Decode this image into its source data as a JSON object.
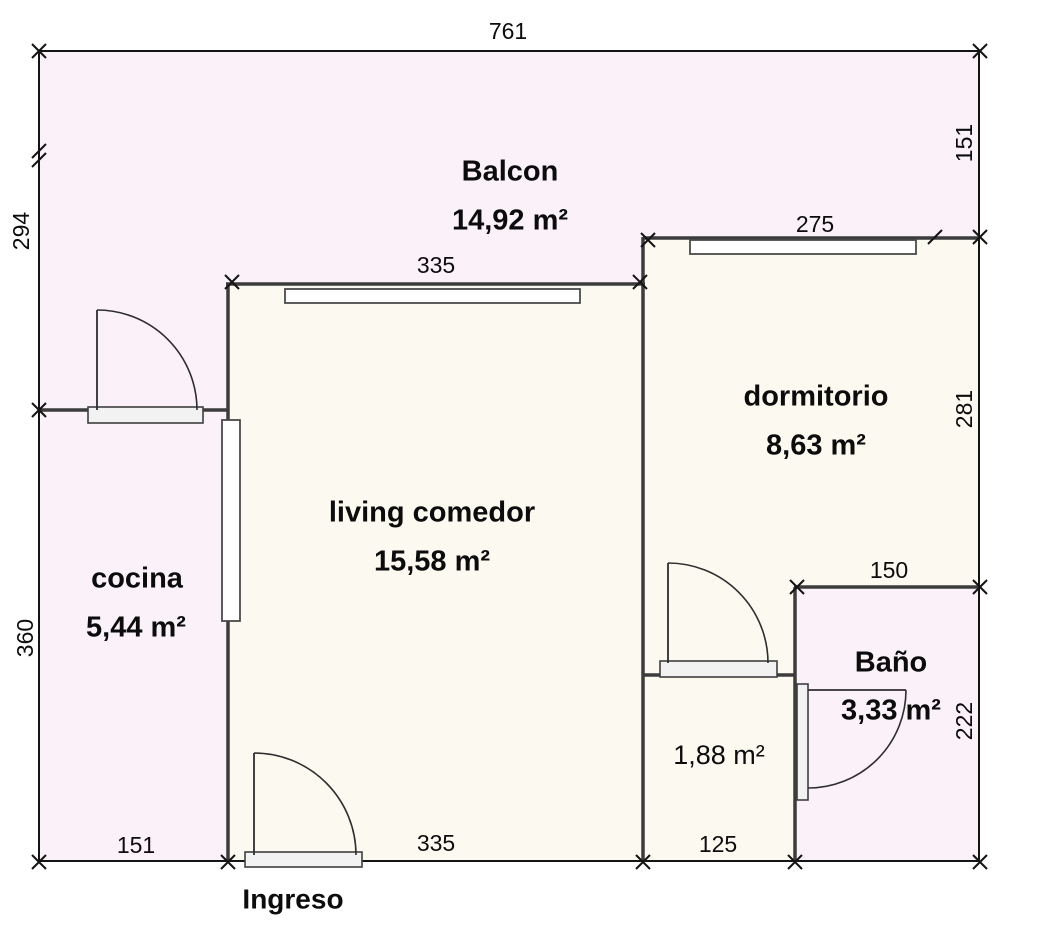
{
  "plan": {
    "entrance_label": "Ingreso"
  },
  "rooms": {
    "balcony": {
      "name": "Balcon",
      "area": "14,92 m²"
    },
    "living": {
      "name": "living comedor",
      "area": "15,58 m²"
    },
    "kitchen": {
      "name": "cocina",
      "area": "5,44 m²"
    },
    "bedroom": {
      "name": "dormitorio",
      "area": "8,63 m²"
    },
    "bathroom": {
      "name": "Baño",
      "area": "3,33 m²"
    },
    "hall": {
      "area": "1,88 m²"
    }
  },
  "dimensions": {
    "overall_width_top": "761",
    "balcony_height_left": "294",
    "kitchen_height_left": "360",
    "balcony_height_right": "151",
    "bedroom_height_right": "281",
    "bathroom_height_right": "222",
    "living_width_top": "335",
    "bedroom_width_top": "275",
    "bathroom_width_top": "150",
    "living_width_bottom": "335",
    "hall_width_bottom": "125",
    "kitchen_width_bottom": "151"
  },
  "colors": {
    "room_pink": "#faf1f9",
    "room_cream": "#fbf9f0",
    "wall": "#3c3c3c",
    "outline": "#141414"
  }
}
